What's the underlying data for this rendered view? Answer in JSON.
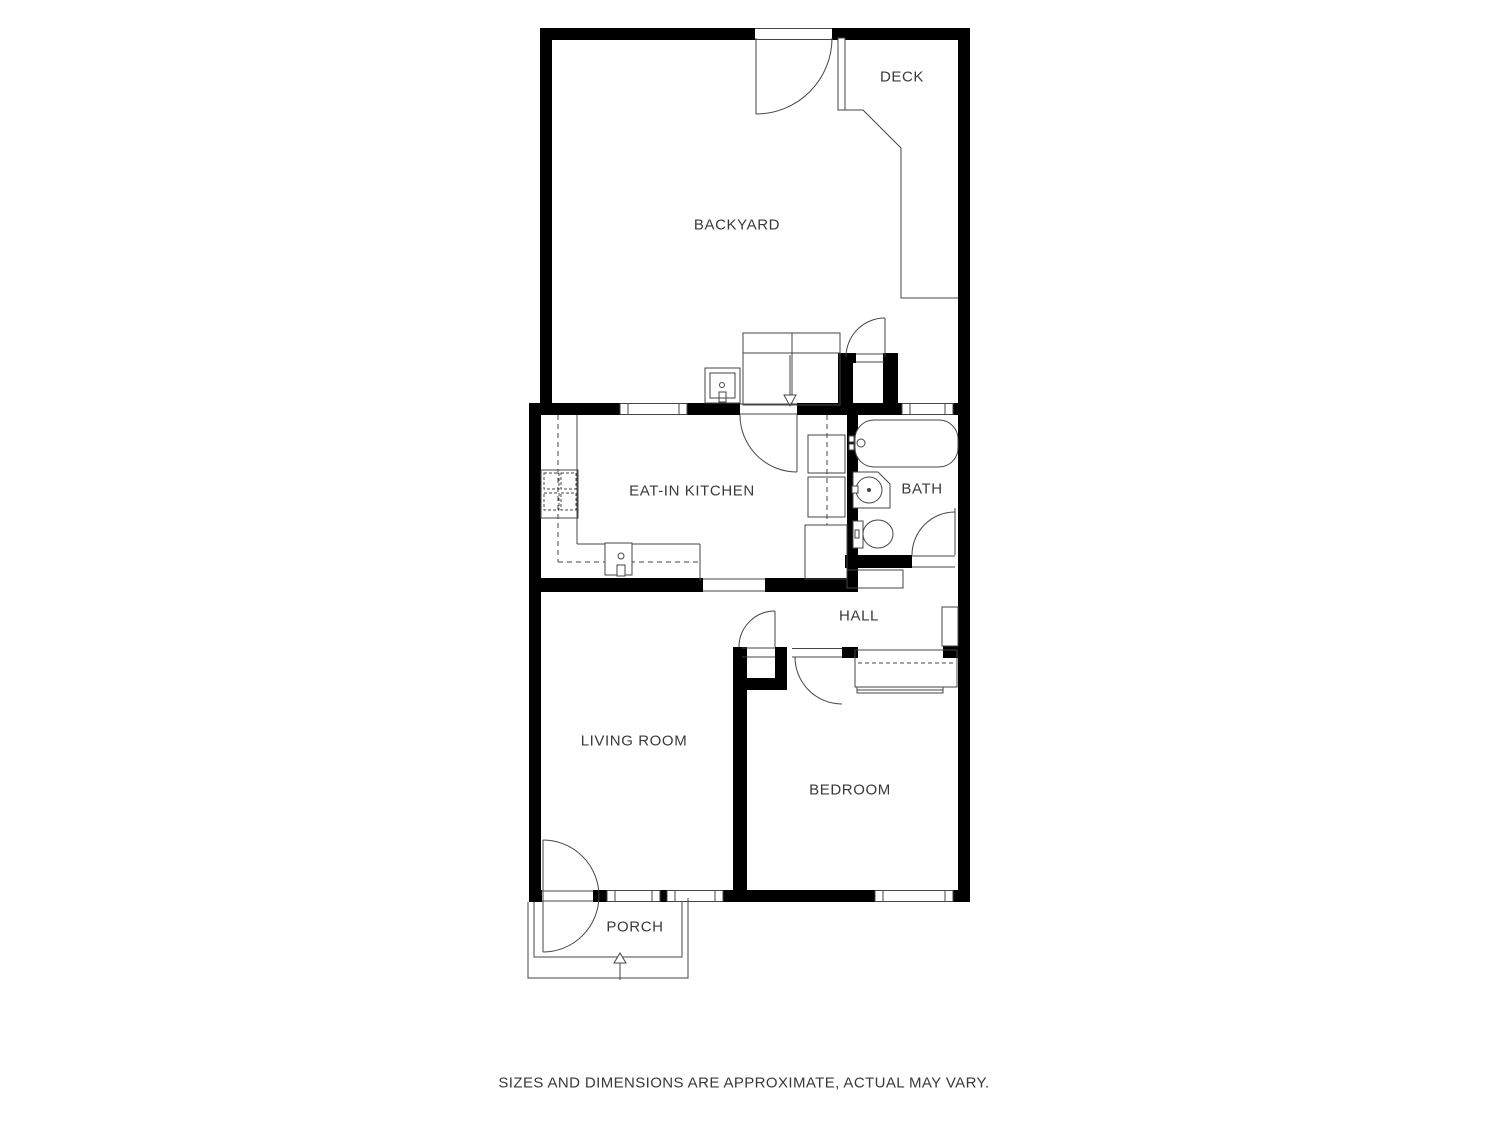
{
  "floorplan": {
    "labels": {
      "deck": "DECK",
      "backyard": "BACKYARD",
      "kitchen": "EAT-IN KITCHEN",
      "bath": "BATH",
      "hall": "HALL",
      "living_room": "LIVING ROOM",
      "bedroom": "BEDROOM",
      "porch": "PORCH"
    },
    "disclaimer": "SIZES AND DIMENSIONS ARE APPROXIMATE, ACTUAL MAY VARY.",
    "colors": {
      "wall": "#000000",
      "fixture_line": "#454545",
      "text": "#3a3a3a",
      "background": "#ffffff"
    }
  }
}
